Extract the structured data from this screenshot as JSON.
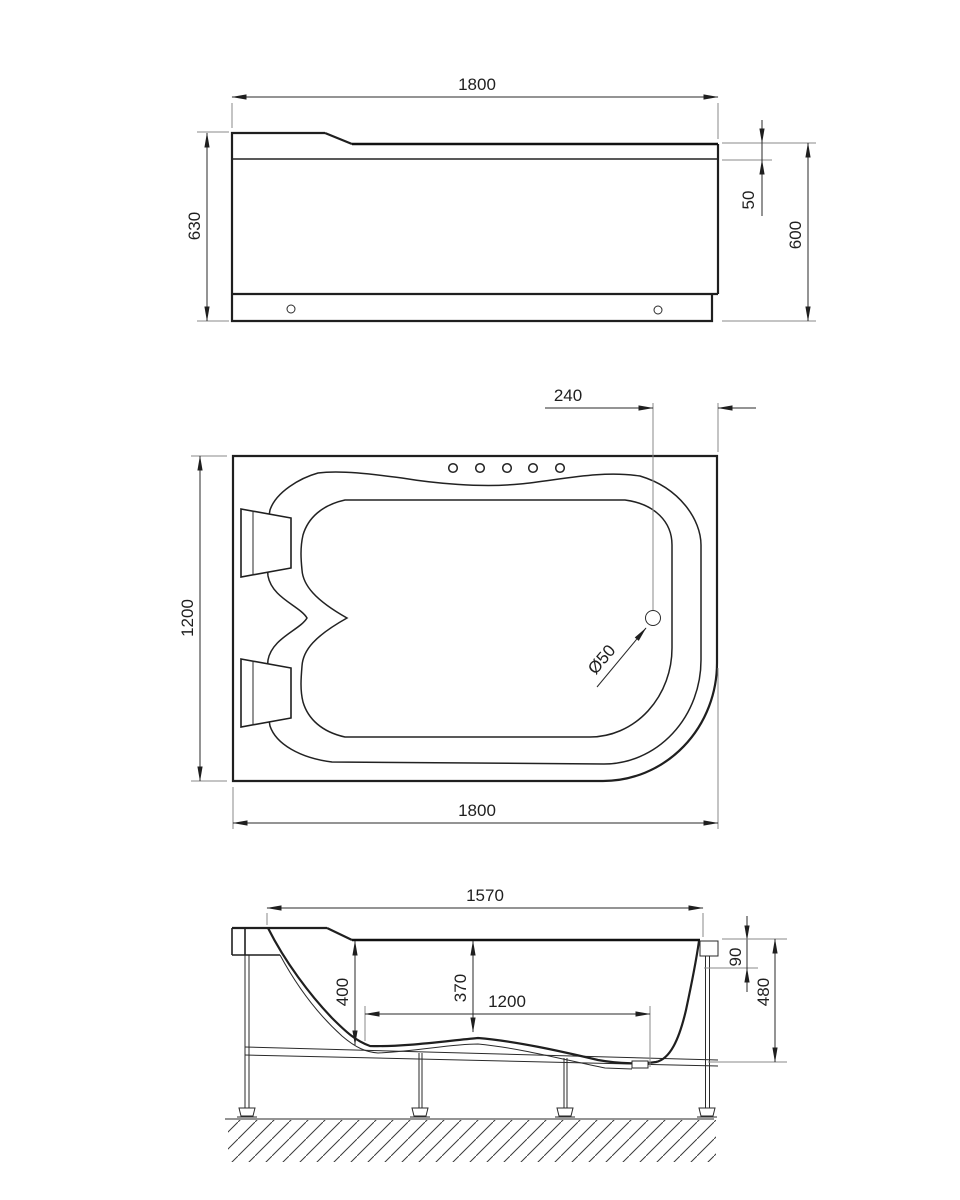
{
  "meta": {
    "drawing_type": "bathtub three-view technical drawing",
    "background_color": "#ffffff",
    "line_color": "#1f1f1f"
  },
  "front_view": {
    "length": "1800",
    "height": "630",
    "rim_height": "50",
    "skirt_height": "600"
  },
  "plan_view": {
    "drain_offset": "240",
    "width": "1200",
    "length": "1800",
    "drain_diameter": "Ø50"
  },
  "side_view": {
    "rim_length": "1570",
    "depth_rear": "400",
    "depth_center": "370",
    "floor_length": "1200",
    "rim_drop": "90",
    "frame_height": "480"
  }
}
